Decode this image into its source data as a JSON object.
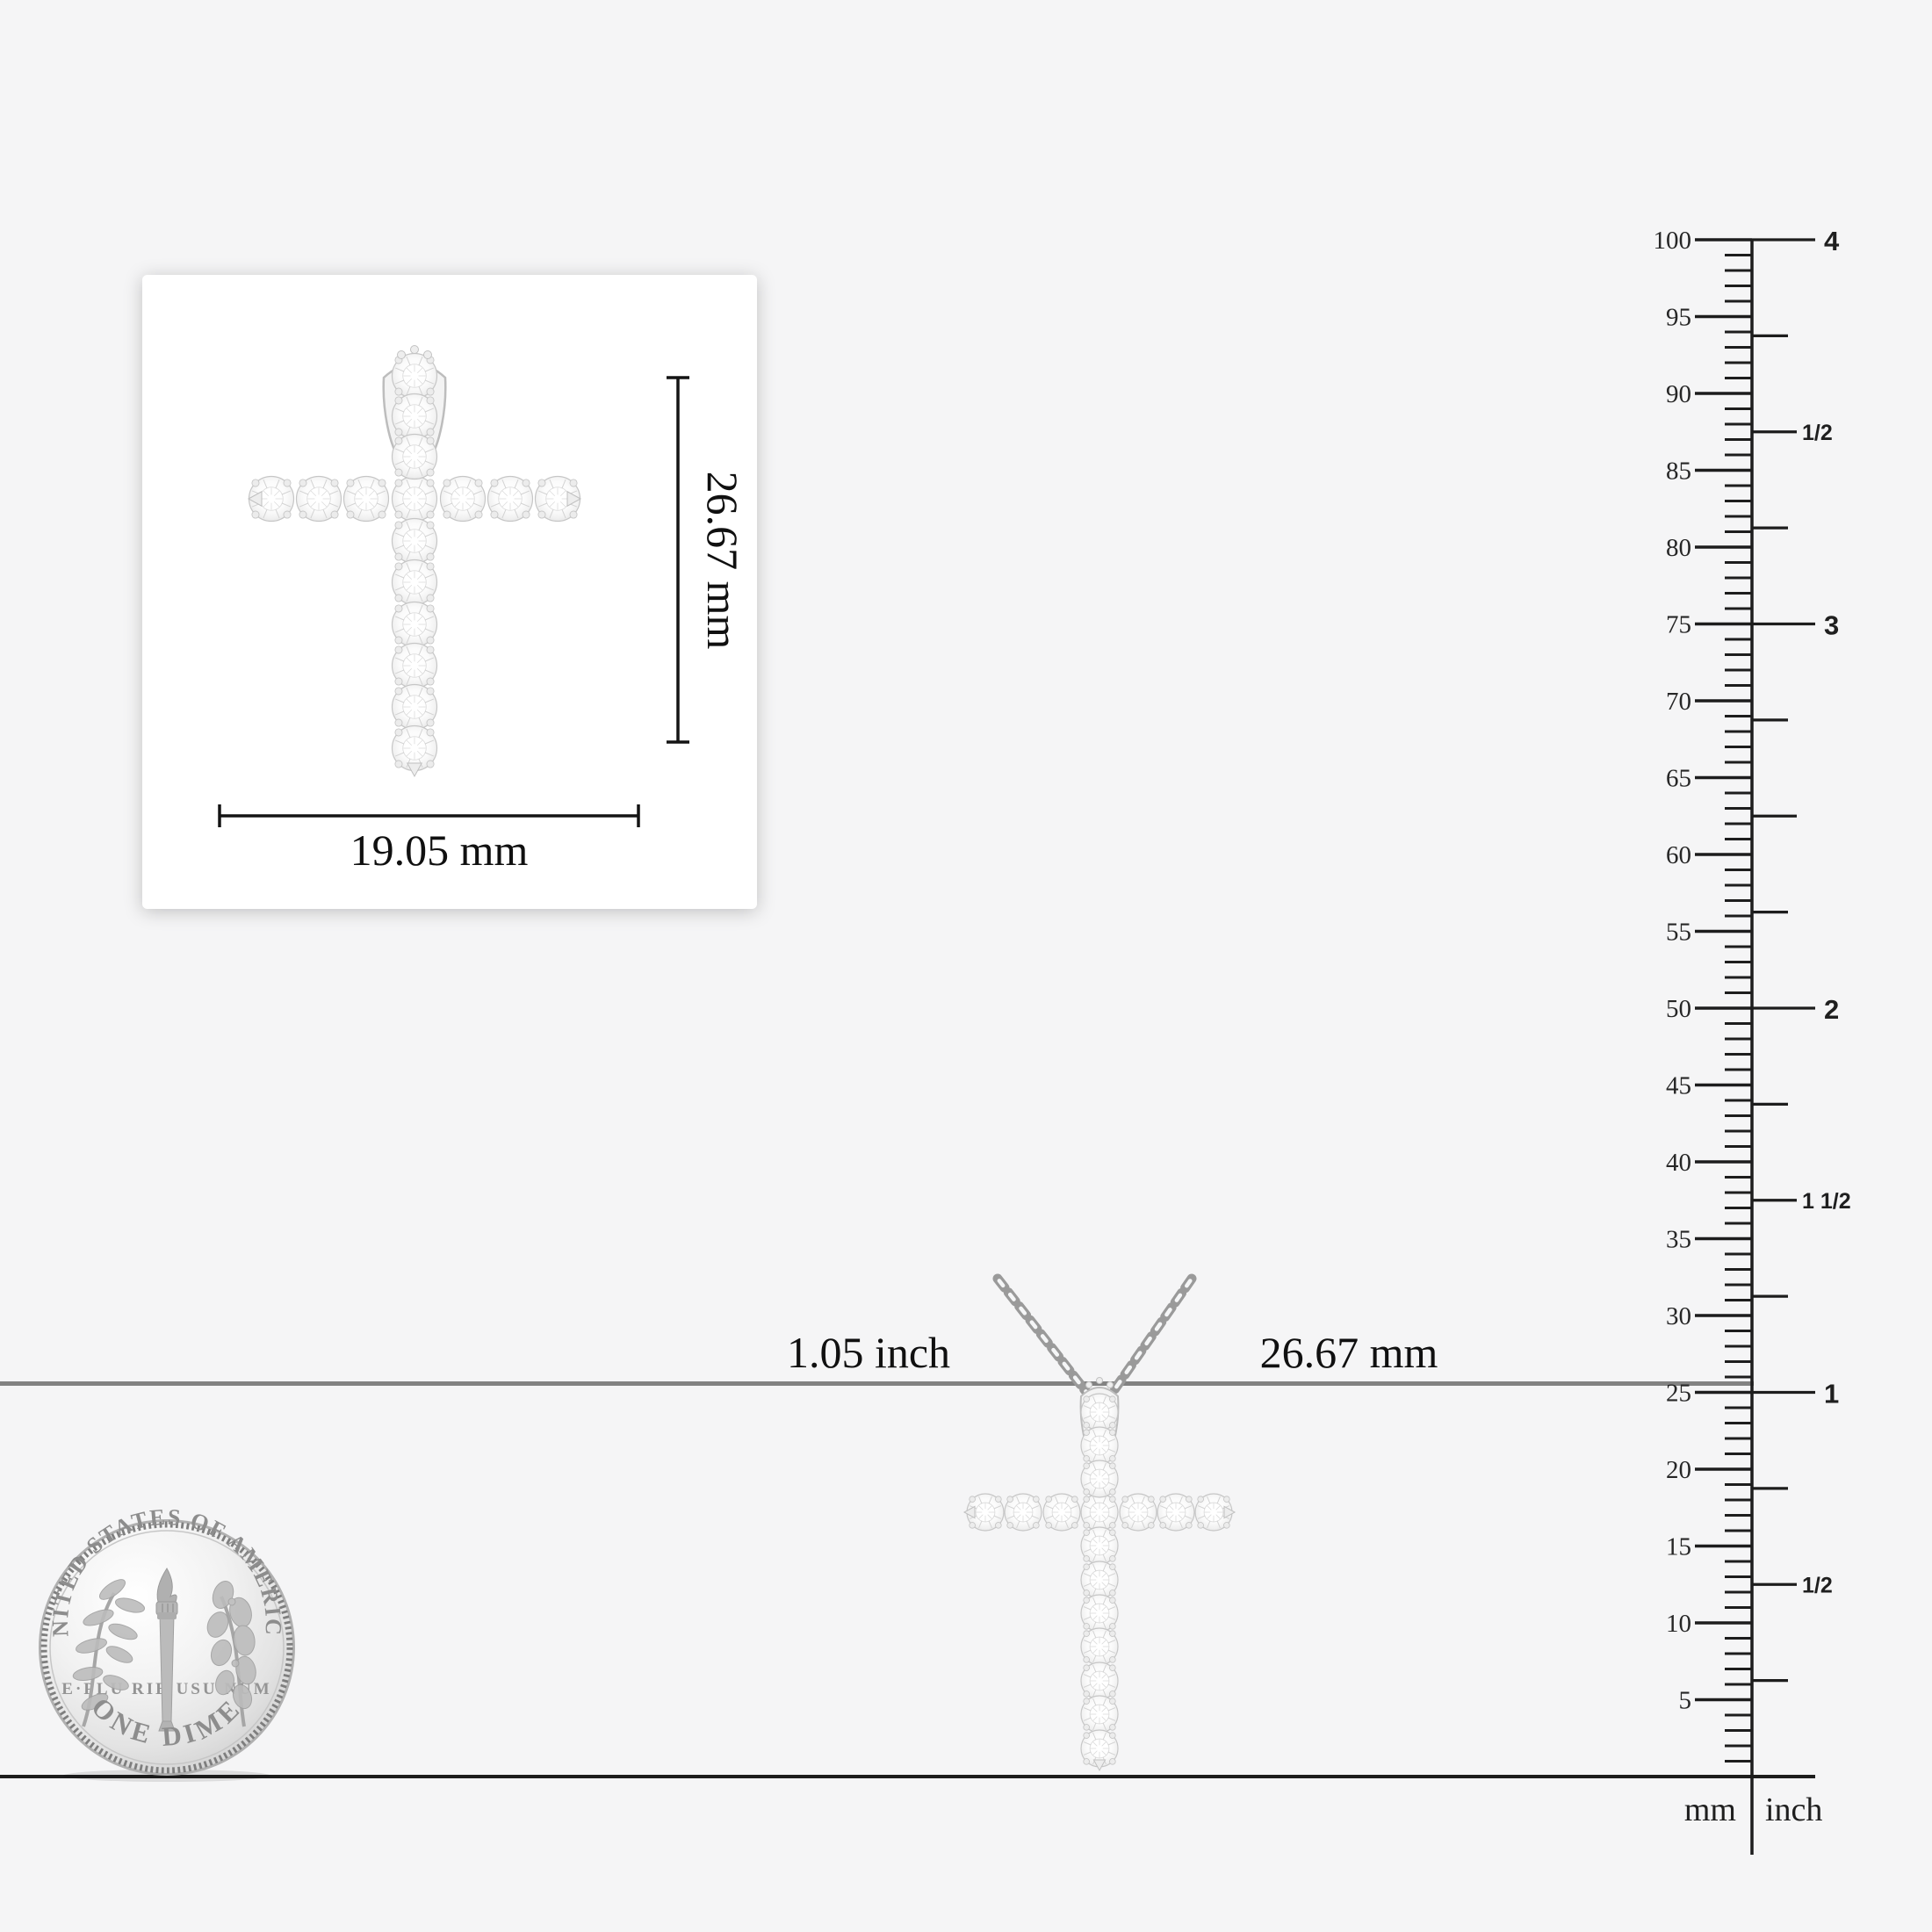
{
  "image": {
    "background_color": "#f5f5f6",
    "baseline_color": "#1d1d1d",
    "comparison_line_color": "#828282"
  },
  "card": {
    "height_label": "26.67 mm",
    "width_label": "19.05 mm"
  },
  "pendant_labels": {
    "inch_label": "1.05 inch",
    "mm_label": "26.67 mm"
  },
  "ruler": {
    "left_unit": "mm",
    "right_unit": "inch",
    "mm_max": 100,
    "mm_tick_step": 1,
    "mm_label_step": 5,
    "mm_labels": [
      5,
      10,
      15,
      20,
      25,
      30,
      35,
      40,
      45,
      50,
      55,
      60,
      65,
      70,
      75,
      80,
      85,
      90,
      95,
      100
    ],
    "inch_labels": [
      {
        "quarters": 16,
        "label": "4"
      },
      {
        "quarters": 14,
        "label": "1/2"
      },
      {
        "quarters": 12,
        "label": "3"
      },
      {
        "quarters": 8,
        "label": "2"
      },
      {
        "quarters": 6,
        "label": "1 1/2"
      },
      {
        "quarters": 4,
        "label": "1"
      },
      {
        "quarters": 2,
        "label": "1/2"
      }
    ]
  },
  "coin": {
    "top_text": "UNITED STATES OF AMERICA",
    "middle_text": "E·PLU RIB USU NUM",
    "bottom_text": "ONE DIME"
  }
}
